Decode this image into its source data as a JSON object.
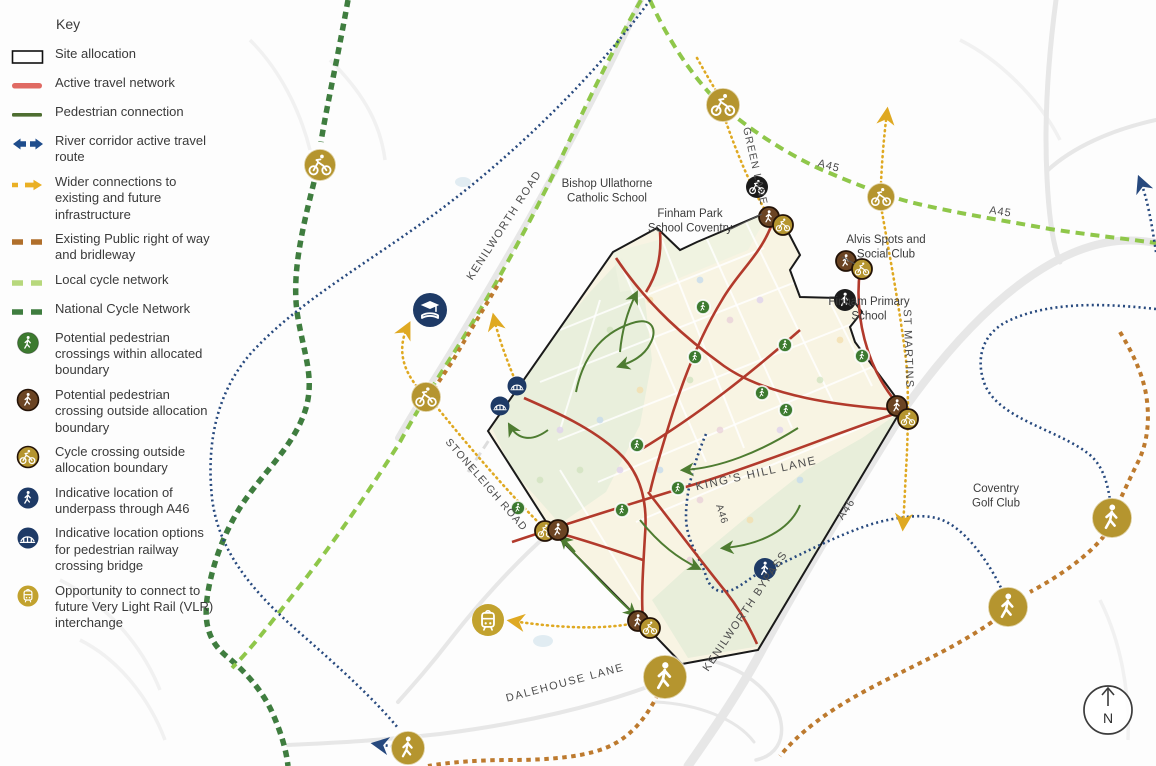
{
  "legend": {
    "title": "Key",
    "items": [
      {
        "label": "Site allocation",
        "icon": "site-allocation-swatch"
      },
      {
        "label": "Active travel network",
        "icon": "active-travel-line"
      },
      {
        "label": "Pedestrian connection",
        "icon": "pedestrian-line"
      },
      {
        "label": "River corridor active travel route",
        "icon": "river-corridor-arrows"
      },
      {
        "label": "Wider connections to existing and future infrastructure",
        "icon": "wider-connections-arrow"
      },
      {
        "label": "Existing Public right of way and bridleway",
        "icon": "prow-dashes"
      },
      {
        "label": "Local cycle network",
        "icon": "local-cycle-dashes"
      },
      {
        "label": "National Cycle Network",
        "icon": "national-cycle-dashes"
      },
      {
        "label": "Potential pedestrian crossings within allocated boundary",
        "icon": "green-pedestrian-circle"
      },
      {
        "label": "Potential pedestrian crossing outside allocation boundary",
        "icon": "brown-pedestrian-circle"
      },
      {
        "label": "Cycle crossing outside allocation boundary",
        "icon": "yellow-cycle-circle"
      },
      {
        "label": "Indicative location of underpass through A46",
        "icon": "blue-pedestrian-circle"
      },
      {
        "label": "Indicative location options for pedestrian railway crossing bridge",
        "icon": "blue-bridge-circle"
      },
      {
        "label": "Opportunity to connect to future Very Light Rail (VLR) interchange",
        "icon": "yellow-tram-circle"
      }
    ]
  },
  "map": {
    "labels": {
      "bishop": [
        "Bishop Ullathorne",
        "Catholic School"
      ],
      "finham_park": [
        "Finham Park",
        "School Coventry"
      ],
      "alvis": [
        "Alvis Spots and",
        "Social Club"
      ],
      "finham_primary": [
        "Finham Primary",
        "School"
      ],
      "golf": [
        "Coventry",
        "Golf Club"
      ]
    },
    "roads": {
      "kenilworth_road": "KENILWORTH ROAD",
      "green_lane": "GREEN LANE",
      "a45_west": "A45",
      "a45_east": "A45",
      "st_martins": "ST MARTINS",
      "stoneleigh_road": "STONELEIGH ROAD",
      "kings_hill_lane": "KING'S HILL LANE",
      "a46_small": "A46",
      "a46_bypass": "A46",
      "kenilworth_bypass": "KENILWORTH BYPASS",
      "dalehouse_lane": "DALEHOUSE LANE"
    },
    "north_label": "N",
    "colors": {
      "active_travel": "#b23a2c",
      "active_travel_legend": "#e06a63",
      "pedestrian": "#4e7c31",
      "river_corridor": "#27497e",
      "wider_connections": "#dfa922",
      "prow": "#bd7a2e",
      "local_cycle": "#8fc74a",
      "local_cycle_legend": "#b7d87c",
      "national_cycle": "#3f7d3f",
      "crossing_green": "#3c7a2f",
      "crossing_brown": "#6b4423",
      "crossing_yellow": "#b5952f",
      "navy": "#1e3a66",
      "black": "#1b1b1b",
      "boundary": "#1a1a1a",
      "road_label": "#4c4c4c"
    }
  }
}
